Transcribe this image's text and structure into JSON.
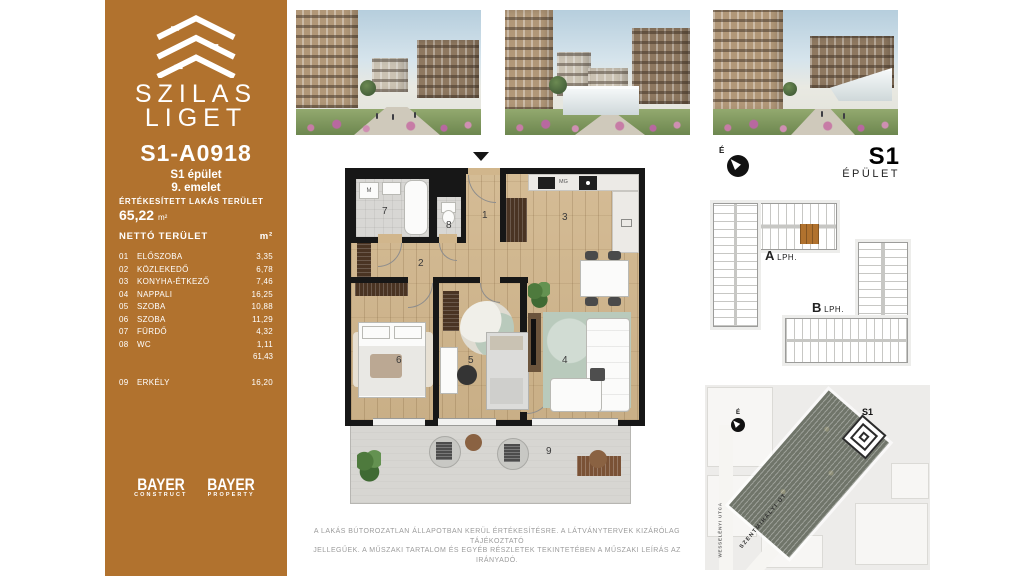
{
  "sidebar": {
    "brand_line1": "SZILAS",
    "brand_line2": "LIGET",
    "unit_id": "S1-A0918",
    "building": "S1 épület",
    "floor": "9. emelet",
    "sold_area_label": "ÉRTÉKESÍTETT LAKÁS TERÜLET",
    "sold_area_value": "65,22",
    "sold_area_unit": "m²",
    "table": {
      "header_label": "NETTÓ TERÜLET",
      "header_unit": "m²",
      "rows": [
        {
          "num": "01",
          "name": "ELŐSZOBA",
          "area": "3,35"
        },
        {
          "num": "02",
          "name": "KÖZLEKEDŐ",
          "area": "6,78"
        },
        {
          "num": "03",
          "name": "KONYHA-ÉTKEZŐ",
          "area": "7,46"
        },
        {
          "num": "04",
          "name": "NAPPALI",
          "area": "16,25"
        },
        {
          "num": "05",
          "name": "SZOBA",
          "area": "10,88"
        },
        {
          "num": "06",
          "name": "SZOBA",
          "area": "11,29"
        },
        {
          "num": "07",
          "name": "FÜRDŐ",
          "area": "4,32"
        },
        {
          "num": "08",
          "name": "WC",
          "area": "1,11"
        }
      ],
      "subtotal": "61,43",
      "balcony_row": {
        "num": "09",
        "name": "ERKÉLY",
        "area": "16,20"
      }
    },
    "logos": [
      {
        "name": "BAYER",
        "division": "CONSTRUCT"
      },
      {
        "name": "BAYER",
        "division": "PROPERTY"
      }
    ]
  },
  "floorplan": {
    "room_numbers": [
      "1",
      "2",
      "3",
      "4",
      "5",
      "6",
      "7",
      "8",
      "9"
    ],
    "labels": {
      "washer": "M",
      "microwave": "MG"
    }
  },
  "right_panel": {
    "compass_letter": "É",
    "building_code": "S1",
    "building_word": "ÉPÜLET",
    "stair_a_letter": "A",
    "stair_a_label": "LPH.",
    "stair_b_letter": "B",
    "stair_b_label": "LPH.",
    "map": {
      "compass_letter": "É",
      "marker": "S1",
      "street_main": "SZENTMIHÁLYI ÚT",
      "street_side": "WESSELÉNYI UTCA"
    }
  },
  "footer": {
    "disclaimer_line1": "A LAKÁS BÚTOROZATLAN ÁLLAPOTBAN KERÜL ÉRTÉKESÍTÉSRE. A LÁTVÁNYTERVEK KIZÁRÓLAG TÁJÉKOZTATÓ",
    "disclaimer_line2": "JELLEGŰEK. A MŰSZAKI TARTALOM ÉS EGYÉB RÉSZLETEK TEKINTETÉBEN A MŰSZAKI LEÍRÁS AZ IRÁNYADÓ."
  },
  "colors": {
    "brand_brown": "#B1722E",
    "site_fill": "#70756A"
  }
}
